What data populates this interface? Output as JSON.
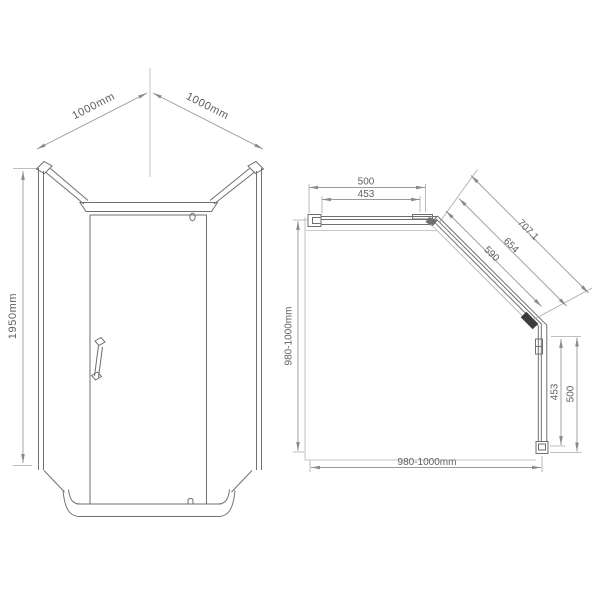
{
  "front_view": {
    "dim_top_left_label": "1000mm",
    "dim_top_right_label": "1000mm",
    "dim_height_label": "1950mm"
  },
  "plan_view": {
    "dim_side_panel_outer_label": "500",
    "dim_side_panel_inner_label": "453",
    "dim_diagonal_outer_label": "707.1",
    "dim_diagonal_middle_label": "654",
    "dim_diagonal_inner_label": "590",
    "dim_right_panel_inner_label": "453",
    "dim_right_panel_outer_label": "500",
    "dim_depth_left_label": "980-1000mm",
    "dim_width_bottom_label": "980-1000mm"
  },
  "colors": {
    "background": "#ffffff",
    "line": "#6f6f6f",
    "dim_line": "#9a9a9a",
    "ext_line": "#a9a9a9",
    "boundary": "#b4b4b4",
    "text": "#5f5f5f",
    "hinge": "#3c3c3c"
  }
}
